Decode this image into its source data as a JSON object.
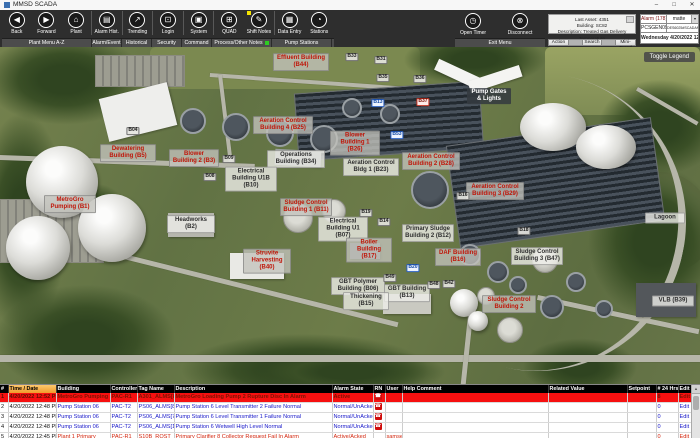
{
  "window": {
    "title": "MMSD SCADA",
    "minimize": "–",
    "maximize": "□",
    "close": "✕"
  },
  "toolbar": {
    "buttons": [
      {
        "label": "Back",
        "icon": "◀",
        "icon_name": "back-icon"
      },
      {
        "label": "Forward",
        "icon": "▶",
        "icon_name": "forward-icon"
      },
      {
        "label": "Plant",
        "icon": "⌂",
        "icon_name": "plant-home-icon"
      },
      {
        "label": "Alarm Hist.",
        "icon": "▤",
        "icon_name": "alarm-history-icon"
      },
      {
        "label": "Trending",
        "icon": "↗",
        "icon_name": "trending-icon"
      },
      {
        "label": "Login",
        "icon": "⊡",
        "icon_name": "login-lock-icon"
      },
      {
        "label": "System",
        "icon": "▣",
        "icon_name": "system-icon"
      },
      {
        "label": "QUAD",
        "icon": "⊞",
        "icon_name": "quad-grid-icon"
      },
      {
        "label": "Shift Notes",
        "icon": "✎",
        "icon_name": "shift-notes-pencil-icon",
        "badge": "#f5e400"
      },
      {
        "label": "Data Entry",
        "icon": "▦",
        "icon_name": "data-entry-icon"
      },
      {
        "label": "Stations",
        "icon": "◔",
        "icon_name": "stations-icon"
      }
    ],
    "groups": [
      {
        "label": "Plant Menu A-Z",
        "span": 3
      },
      {
        "label": "Alarm/Event",
        "span": 1
      },
      {
        "label": "Historical",
        "span": 1
      },
      {
        "label": "Security",
        "span": 1
      },
      {
        "label": "Command",
        "span": 1
      },
      {
        "label": "Process/Other Notes",
        "span": 2,
        "badge": "#2ecc22"
      },
      {
        "label": "Pump Stations",
        "span": 2
      }
    ],
    "right": {
      "open_timer": "Open Timer",
      "open_timer_icon": "◷",
      "disconnect": "Disconnect",
      "disconnect_icon": "⊗",
      "exit_menu": "Exit Menu",
      "asset_line1": "Last Asset: 4351",
      "asset_line2": "Building: SC82",
      "asset_line3": "Description: Treated Gas Delivery Temperature",
      "action": "Action",
      "search": "Search",
      "mini_trend": "Mini-Trend",
      "alarm_count": "Alarm (178)",
      "user": "matte",
      "user_dropdown_icon": "▾",
      "node": "PCSGEN09",
      "station": "DES6025#SCADANT003",
      "datetime": "Wednesday 4/20/2022 12:53:28 PM"
    }
  },
  "map": {
    "toggle_legend": "Toggle Legend",
    "labels": [
      {
        "text": "Effluent Building (B44)",
        "x": 301,
        "y": 15,
        "type": "red",
        "w": 50
      },
      {
        "text": "B33",
        "x": 352,
        "y": 10,
        "type": "tag"
      },
      {
        "text": "B31",
        "x": 381,
        "y": 13,
        "type": "tag"
      },
      {
        "text": "B35",
        "x": 383,
        "y": 31,
        "type": "tag"
      },
      {
        "text": "B36",
        "x": 420,
        "y": 32,
        "type": "tag"
      },
      {
        "text": "Pump Gates & Lights",
        "x": 489,
        "y": 49,
        "type": "darklabel",
        "w": 40
      },
      {
        "text": "B04",
        "x": 133,
        "y": 84,
        "type": "tag"
      },
      {
        "text": "Dewatering Building (B5)",
        "x": 128,
        "y": 106,
        "type": "red",
        "w": 50
      },
      {
        "text": "Blower Building 2 (B3)",
        "x": 194,
        "y": 111,
        "type": "red",
        "w": 44
      },
      {
        "text": "B09",
        "x": 229,
        "y": 112,
        "type": "tag"
      },
      {
        "text": "B08",
        "x": 210,
        "y": 130,
        "type": "tag"
      },
      {
        "text": "MetroGro Pumping (B1)",
        "x": 70,
        "y": 157,
        "type": "red",
        "w": 46
      },
      {
        "text": "Headworks (B2)",
        "x": 191,
        "y": 177,
        "type": "dark",
        "w": 42
      },
      {
        "text": "Aeration Control Building 4 (B25)",
        "x": 283,
        "y": 78,
        "type": "red",
        "w": 54
      },
      {
        "text": "Blower Building 1 (B26)",
        "x": 355,
        "y": 96,
        "type": "red",
        "w": 44
      },
      {
        "text": "B13",
        "x": 378,
        "y": 56,
        "type": "tag-blue"
      },
      {
        "text": "B37",
        "x": 423,
        "y": 55,
        "type": "tag-red"
      },
      {
        "text": "B53",
        "x": 397,
        "y": 88,
        "type": "tag-blue"
      },
      {
        "text": "Operations Building (B34)",
        "x": 296,
        "y": 112,
        "type": "dark",
        "w": 52
      },
      {
        "text": "Aeration Control Bldg 1 (B23)",
        "x": 371,
        "y": 120,
        "type": "dark",
        "w": 50
      },
      {
        "text": "Aeration Control Building 2 (B28)",
        "x": 431,
        "y": 114,
        "type": "red",
        "w": 52
      },
      {
        "text": "Electrical Building U1B (B10)",
        "x": 251,
        "y": 132,
        "type": "dark",
        "w": 46
      },
      {
        "text": "Sludge Control Building 1 (B11)",
        "x": 306,
        "y": 160,
        "type": "red",
        "w": 46
      },
      {
        "text": "Electrical Building U1 (B07)",
        "x": 343,
        "y": 182,
        "type": "dark",
        "w": 44
      },
      {
        "text": "B19",
        "x": 366,
        "y": 166,
        "type": "tag"
      },
      {
        "text": "B14",
        "x": 384,
        "y": 175,
        "type": "tag"
      },
      {
        "text": "Primary Sludge Building 2 (B12)",
        "x": 428,
        "y": 186,
        "type": "dark",
        "w": 46
      },
      {
        "text": "Boiler Building (B17)",
        "x": 369,
        "y": 203,
        "type": "red",
        "w": 40
      },
      {
        "text": "DAF Building (B16)",
        "x": 458,
        "y": 210,
        "type": "red",
        "w": 40
      },
      {
        "text": "Struvite Harvesting (B40)",
        "x": 267,
        "y": 214,
        "type": "red",
        "w": 42
      },
      {
        "text": "GBT Polymer Building (B06)",
        "x": 358,
        "y": 239,
        "type": "dark",
        "w": 48
      },
      {
        "text": "B20",
        "x": 413,
        "y": 221,
        "type": "tag-blue"
      },
      {
        "text": "B49",
        "x": 390,
        "y": 231,
        "type": "tag"
      },
      {
        "text": "GBT Building (B13)",
        "x": 407,
        "y": 246,
        "type": "dark",
        "w": 40
      },
      {
        "text": "Thickening (B15)",
        "x": 366,
        "y": 254,
        "type": "dark",
        "w": 40
      },
      {
        "text": "Aeration Control Building 3 (B29)",
        "x": 495,
        "y": 144,
        "type": "red",
        "w": 52
      },
      {
        "text": "B16",
        "x": 463,
        "y": 149,
        "type": "tag"
      },
      {
        "text": "B18",
        "x": 524,
        "y": 184,
        "type": "tag"
      },
      {
        "text": "Sludge Control Building 3 (B47)",
        "x": 537,
        "y": 209,
        "type": "dark",
        "w": 46
      },
      {
        "text": "Lagoon",
        "x": 665,
        "y": 171,
        "type": "dark",
        "w": 34
      },
      {
        "text": "B48",
        "x": 434,
        "y": 238,
        "type": "tag"
      },
      {
        "text": "B42",
        "x": 449,
        "y": 237,
        "type": "tag"
      },
      {
        "text": "Sludge Control Building 2",
        "x": 509,
        "y": 257,
        "type": "red",
        "w": 48
      },
      {
        "text": "VLB (B39)",
        "x": 673,
        "y": 254,
        "type": "dark",
        "w": 36
      }
    ]
  },
  "table": {
    "rn_icon": "☎",
    "scroll_up_icon": "▲",
    "headers": [
      "#",
      "Time / Date",
      "Building",
      "Controller",
      "Tag Name",
      "Description",
      "Alarm State",
      "RN",
      "User",
      "Help Comment",
      "Related Value",
      "Setpoint",
      "# 24 Hrs",
      "Edit"
    ],
    "rows": [
      {
        "num": "1",
        "time": "4/20/2022 12:52 PM",
        "building": "MetroGro Pumping (B1)",
        "controller": "PAC-R1",
        "tag": "A301_ALMS[8]",
        "description": "MetroGro Loading Pump 2 Rupture Disc In Alarm",
        "alarm_state": "Active",
        "rn": true,
        "user": "",
        "help_comment": "",
        "related_value": "",
        "setpoint": "",
        "hrs24": "8",
        "edit": "Edit",
        "state": "active"
      },
      {
        "num": "2",
        "time": "4/20/2022 12:48 PM",
        "building": "Pump Station 06",
        "controller": "PAC-T2",
        "tag": "PS06_ALMS[8]",
        "description": "Pump Station 6 Level Transmitter 2 Failure Normal",
        "alarm_state": "Normal/UnAcked",
        "rn": true,
        "user": "",
        "help_comment": "",
        "related_value": "",
        "setpoint": "",
        "hrs24": "0",
        "edit": "Edit",
        "state": "normal"
      },
      {
        "num": "3",
        "time": "4/20/2022 12:48 PM",
        "building": "Pump Station 06",
        "controller": "PAC-T2",
        "tag": "PS06_ALMS[7]",
        "description": "Pump Station 6 Level Transmitter 1 Failure Normal",
        "alarm_state": "Normal/UnAcked",
        "rn": true,
        "user": "",
        "help_comment": "",
        "related_value": "",
        "setpoint": "",
        "hrs24": "0",
        "edit": "Edit",
        "state": "normal"
      },
      {
        "num": "4",
        "time": "4/20/2022 12:48 PM",
        "building": "Pump Station 06",
        "controller": "PAC-T2",
        "tag": "PS06_ALMS[1]",
        "description": "Pump Station 6 Wetwell High Level Normal",
        "alarm_state": "Normal/UnAcked",
        "rn": true,
        "user": "",
        "help_comment": "",
        "related_value": "",
        "setpoint": "",
        "hrs24": "0",
        "edit": "Edit",
        "state": "normal"
      },
      {
        "num": "5",
        "time": "4/20/2022 12:45 PM",
        "building": "Plant 1 Primary",
        "controller": "PAC-R1",
        "tag": "S10B_RQST_FAIL",
        "description": "Primary Clarifier 8 Collector Request Fail In Alarm",
        "alarm_state": "Active/Acked",
        "rn": false,
        "user": "samsed",
        "help_comment": "",
        "related_value": "",
        "setpoint": "",
        "hrs24": "0",
        "edit": "Edit",
        "state": "acked"
      }
    ]
  }
}
